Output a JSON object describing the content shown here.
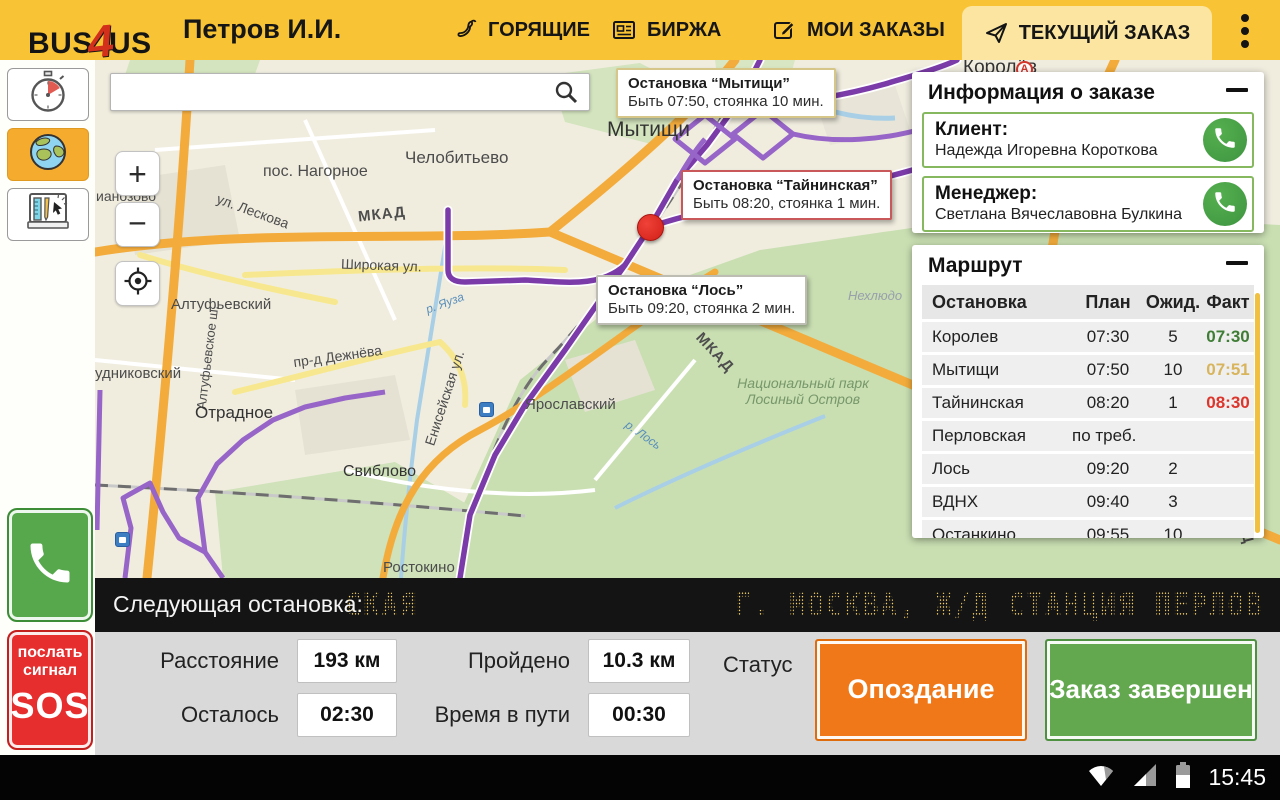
{
  "header": {
    "logo": {
      "part1": "BUS",
      "part2": "4",
      "part3": "US"
    },
    "user_name": "Петров И.И.",
    "tabs": [
      {
        "label": "ГОРЯЩИЕ"
      },
      {
        "label": "БИРЖА"
      },
      {
        "label": "МОИ ЗАКАЗЫ"
      },
      {
        "label": "ТЕКУЩИЙ ЗАКАЗ"
      }
    ]
  },
  "sidebar": {
    "sos": {
      "line1": "послать",
      "line2": "сигнал",
      "line3": "SOS"
    }
  },
  "map": {
    "search": {
      "value": "",
      "placeholder": ""
    },
    "controls": {
      "zoom_in": "+",
      "zoom_out": "−"
    },
    "callouts": [
      {
        "title": "Остановка “Мытищи”",
        "line": "Быть 07:50, стоянка 10 мин."
      },
      {
        "title": "Остановка “Тайнинская”",
        "line": "Быть 08:20, стоянка 1 мин."
      },
      {
        "title": "Остановка “Лось”",
        "line": "Быть 09:20, стоянка 2 мин."
      }
    ],
    "labels": [
      {
        "text": "Мытищи"
      },
      {
        "text": "Челобитьево"
      },
      {
        "text": "пос. Нагорное"
      },
      {
        "text": "МКАД"
      },
      {
        "text": "ул. Лескова"
      },
      {
        "text": "Широкая ул."
      },
      {
        "text": "Алтуфьевское ш."
      },
      {
        "text": "ианозово"
      },
      {
        "text": "Алтуфьевский"
      },
      {
        "text": "удниковский"
      },
      {
        "text": "пр-д Дежнёва"
      },
      {
        "text": "Енисейская ул."
      },
      {
        "text": "Отрадное"
      },
      {
        "text": "Ярославский"
      },
      {
        "text": "Свиблово"
      },
      {
        "text": "Ростокино"
      },
      {
        "text": "Национальный парк Лосиный Остров"
      },
      {
        "text": "Нехлюдо"
      },
      {
        "text": "р. Яуза"
      },
      {
        "text": "р. Лось"
      },
      {
        "text": "МКАД"
      },
      {
        "text": "МКАД"
      },
      {
        "text": "Королёв"
      },
      {
        "text": "А"
      }
    ]
  },
  "order_info": {
    "title": "Информация о заказе",
    "contacts": [
      {
        "role": "Клиент:",
        "name": "Надежда Игоревна Короткова"
      },
      {
        "role": "Менеджер:",
        "name": "Светлана Вячеславовна Булкина"
      }
    ]
  },
  "route": {
    "title": "Маршрут",
    "columns": [
      "Остановка",
      "План",
      "Ожид.",
      "Факт"
    ],
    "rows": [
      {
        "stop": "Королев",
        "plan": "07:30",
        "wait": "5",
        "fact": "07:30"
      },
      {
        "stop": "Мытищи",
        "plan": "07:50",
        "wait": "10",
        "fact": "07:51"
      },
      {
        "stop": "Тайнинская",
        "plan": "08:20",
        "wait": "1",
        "fact": "08:30"
      },
      {
        "stop": "Перловская",
        "plan": "по треб.",
        "wait": "",
        "fact": ""
      },
      {
        "stop": "Лось",
        "plan": "09:20",
        "wait": "2",
        "fact": ""
      },
      {
        "stop": "ВДНХ",
        "plan": "09:40",
        "wait": "3",
        "fact": ""
      },
      {
        "stop": "Останкино",
        "plan": "09:55",
        "wait": "10",
        "fact": ""
      }
    ]
  },
  "marquee": {
    "label": "Следующая остановка:",
    "scroll_left": "СКАЯ",
    "scroll_right": "Г. МОСКВА, Ж/Д СТАНЦИЯ ПЕРЛОВ"
  },
  "stats": {
    "distance_label": "Расстояние",
    "distance_value": "193 км",
    "traveled_label": "Пройдено",
    "traveled_value": "10.3 км",
    "remaining_label": "Осталось",
    "remaining_value": "02:30",
    "entime_label": "Время в пути",
    "entime_value": "00:30",
    "status_label": "Статус",
    "late_button": "Опоздание",
    "complete_button": "Заказ завершен"
  },
  "status_bar": {
    "time": "15:45"
  },
  "colors": {
    "header_yellow": "#F8C334",
    "active_tab": "#FBE5A0",
    "route_purple": "#7B3BA8",
    "late_orange": "#F07818",
    "done_green": "#63A84F",
    "sos_red": "#E62E2E",
    "led_yellow": "#E9C14D",
    "fact_ontime": "#3F7D36",
    "fact_warn": "#D8B45C",
    "fact_late": "#DC352B"
  }
}
